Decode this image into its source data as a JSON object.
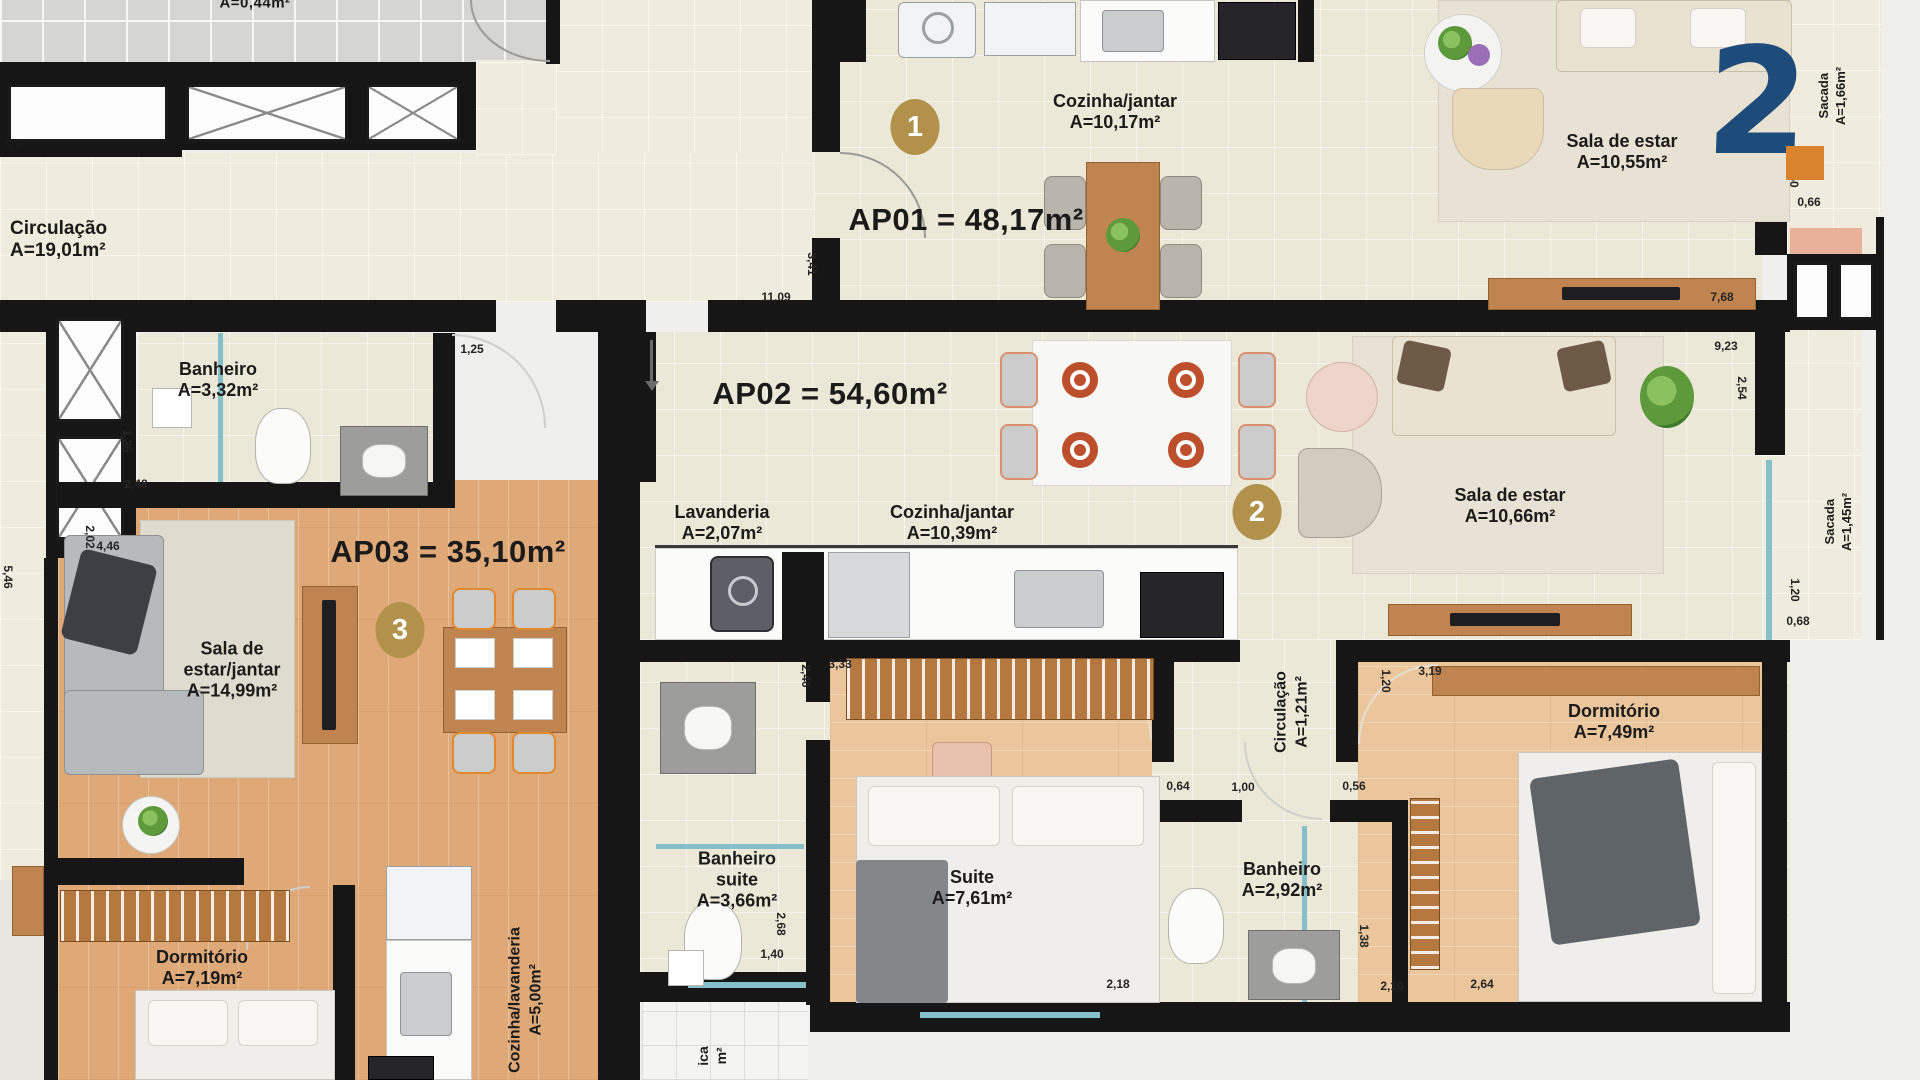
{
  "colors": {
    "badge_gold": "#b2914b",
    "logo_blue": "#1e4c7a",
    "logo_orange": "#d9832e",
    "wall_black": "#161616",
    "glass_teal": "#85bfca",
    "wood_floor": "#dfa877",
    "cream_floor": "#ece8d8"
  },
  "logo": {
    "glyph": "2"
  },
  "badges": [
    {
      "n": "1",
      "x": 915,
      "y": 127
    },
    {
      "n": "2",
      "x": 1257,
      "y": 512
    },
    {
      "n": "3",
      "x": 400,
      "y": 630
    }
  ],
  "labels": [
    {
      "name": "circulacao-hall",
      "lines": [
        "Circulação",
        "A=19,01m²"
      ],
      "x": 10,
      "y": 240,
      "size": 19,
      "align": "left"
    },
    {
      "name": "ap01-title",
      "lines": [
        "AP01 = 48,17m²"
      ],
      "x": 966,
      "y": 220,
      "size": 31,
      "bold": true
    },
    {
      "name": "cozinha-jantar-ap01",
      "lines": [
        "Cozinha/jantar",
        "A=10,17m²"
      ],
      "x": 1115,
      "y": 112,
      "size": 18
    },
    {
      "name": "sala-estar-ap01",
      "lines": [
        "Sala de estar",
        "A=10,55m²"
      ],
      "x": 1622,
      "y": 152,
      "size": 18
    },
    {
      "name": "sacada-ap01",
      "lines": [
        "Sacada",
        "A=1,66m²"
      ],
      "x": 1832,
      "y": 96,
      "size": 13,
      "vertical": true
    },
    {
      "name": "ap02-title",
      "lines": [
        "AP02 = 54,60m²"
      ],
      "x": 830,
      "y": 394,
      "size": 31,
      "bold": true
    },
    {
      "name": "lavanderia-ap02",
      "lines": [
        "Lavanderia",
        "A=2,07m²"
      ],
      "x": 722,
      "y": 523,
      "size": 18
    },
    {
      "name": "cozinha-jantar-ap02",
      "lines": [
        "Cozinha/jantar",
        "A=10,39m²"
      ],
      "x": 952,
      "y": 523,
      "size": 18
    },
    {
      "name": "sala-estar-ap02",
      "lines": [
        "Sala de estar",
        "A=10,66m²"
      ],
      "x": 1510,
      "y": 506,
      "size": 18
    },
    {
      "name": "sacada-ap02",
      "lines": [
        "Sacada",
        "A=1,45m²"
      ],
      "x": 1838,
      "y": 522,
      "size": 13,
      "vertical": true
    },
    {
      "name": "ap03-title",
      "lines": [
        "AP03 = 35,10m²"
      ],
      "x": 448,
      "y": 552,
      "size": 31,
      "bold": true
    },
    {
      "name": "banheiro-ap03",
      "lines": [
        "Banheiro",
        "A=3,32m²"
      ],
      "x": 218,
      "y": 380,
      "size": 18
    },
    {
      "name": "sala-estar-jantar-ap03",
      "lines": [
        "Sala de",
        "estar/jantar",
        "A=14,99m²"
      ],
      "x": 232,
      "y": 670,
      "size": 18
    },
    {
      "name": "dormitorio-ap03",
      "lines": [
        "Dormitório",
        "A=7,19m²"
      ],
      "x": 202,
      "y": 968,
      "size": 18
    },
    {
      "name": "cozinha-lavanderia-ap03",
      "lines": [
        "Cozinha/lavanderia",
        "A=5,00m²"
      ],
      "x": 526,
      "y": 1000,
      "size": 16,
      "vertical": true
    },
    {
      "name": "banheiro-suite",
      "lines": [
        "Banheiro",
        "suite",
        "A=3,66m²"
      ],
      "x": 737,
      "y": 880,
      "size": 18
    },
    {
      "name": "suite",
      "lines": [
        "Suite",
        "A=7,61m²"
      ],
      "x": 972,
      "y": 888,
      "size": 18
    },
    {
      "name": "banheiro-ap02",
      "lines": [
        "Banheiro",
        "A=2,92m²"
      ],
      "x": 1282,
      "y": 880,
      "size": 18
    },
    {
      "name": "circulacao-ap02",
      "lines": [
        "Circulação",
        "A=1,21m²"
      ],
      "x": 1292,
      "y": 712,
      "size": 16,
      "vertical": true
    },
    {
      "name": "dormitorio-ap02",
      "lines": [
        "Dormitório",
        "A=7,49m²"
      ],
      "x": 1614,
      "y": 722,
      "size": 18
    },
    {
      "name": "cut-top",
      "lines": [
        "A=0,44m²"
      ],
      "x": 255,
      "y": 3,
      "size": 15,
      "bold": true
    },
    {
      "name": "cut-left",
      "lines": [
        "ST"
      ],
      "x": 14,
      "y": 146,
      "size": 12,
      "bold": true
    },
    {
      "name": "cut-bottom",
      "lines": [
        "ica",
        "m²"
      ],
      "x": 712,
      "y": 1056,
      "size": 14,
      "vertical": true
    }
  ],
  "dimensions": [
    {
      "t": "11,09",
      "x": 776,
      "y": 297
    },
    {
      "t": "3,41",
      "x": 812,
      "y": 264,
      "v": true
    },
    {
      "t": "7,68",
      "x": 1722,
      "y": 297
    },
    {
      "t": "1,50",
      "x": 1794,
      "y": 176,
      "v": true
    },
    {
      "t": "0,66",
      "x": 1809,
      "y": 202
    },
    {
      "t": "9,23",
      "x": 1726,
      "y": 346
    },
    {
      "t": "2,54",
      "x": 1742,
      "y": 388,
      "v": true
    },
    {
      "t": "1,25",
      "x": 472,
      "y": 349
    },
    {
      "t": "1,35",
      "x": 127,
      "y": 441,
      "v": true
    },
    {
      "t": "2,48",
      "x": 136,
      "y": 484
    },
    {
      "t": "2,02",
      "x": 90,
      "y": 537,
      "v": true
    },
    {
      "t": "4,46",
      "x": 108,
      "y": 546
    },
    {
      "t": "5,46",
      "x": 8,
      "y": 577,
      "v": true
    },
    {
      "t": "2,40",
      "x": 806,
      "y": 676,
      "v": true
    },
    {
      "t": "3,33",
      "x": 840,
      "y": 664
    },
    {
      "t": "0,64",
      "x": 1178,
      "y": 786
    },
    {
      "t": "1,00",
      "x": 1243,
      "y": 787
    },
    {
      "t": "0,56",
      "x": 1354,
      "y": 786
    },
    {
      "t": "1,20",
      "x": 1386,
      "y": 681,
      "v": true
    },
    {
      "t": "3,19",
      "x": 1430,
      "y": 671
    },
    {
      "t": "2,68",
      "x": 781,
      "y": 924,
      "v": true
    },
    {
      "t": "1,40",
      "x": 772,
      "y": 954
    },
    {
      "t": "1,38",
      "x": 1364,
      "y": 936,
      "v": true
    },
    {
      "t": "2,18",
      "x": 1118,
      "y": 984
    },
    {
      "t": "2,10",
      "x": 1392,
      "y": 986
    },
    {
      "t": "2,64",
      "x": 1482,
      "y": 984
    },
    {
      "t": "1,20",
      "x": 1795,
      "y": 590,
      "v": true
    },
    {
      "t": "0,68",
      "x": 1798,
      "y": 621
    }
  ]
}
